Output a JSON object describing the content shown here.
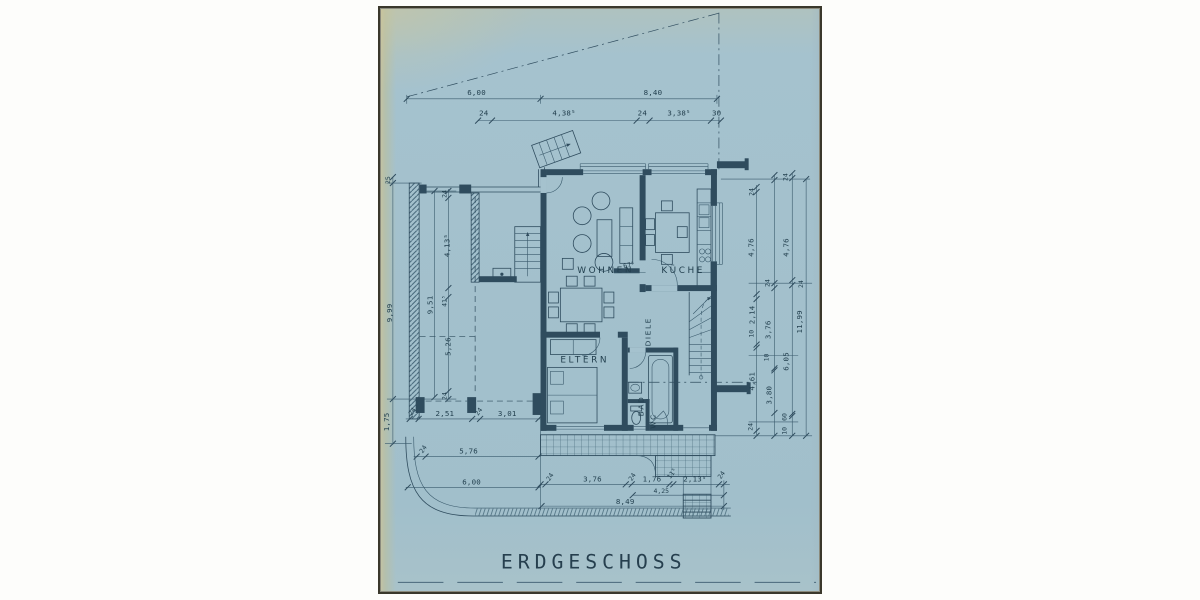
{
  "title": "ERDGESCHOSS",
  "rooms": {
    "wohnen": "WOHNEN",
    "kueche": "KÜCHE",
    "diele": "DIELE",
    "eltern": "ELTERN",
    "bad": "BAD",
    "wc": "WC"
  },
  "dims": {
    "top": {
      "t1": "6,00",
      "t2": "8,40",
      "t3": "24",
      "t4": "4,38⁵",
      "t5": "24",
      "t6": "3,38⁵",
      "t7": "30"
    },
    "left": {
      "l1": "25",
      "l2": "9,99",
      "l3": "9,51",
      "l4": "24",
      "l5": "4,13⁵",
      "l6": "41⁵",
      "l7": "5,26",
      "l8": "24",
      "l9": "1,75"
    },
    "bottom_left": {
      "b1": "24",
      "b2": "2,51",
      "b3": "24",
      "b4": "3,01",
      "b5": "24",
      "b6": "5,76",
      "b7": "6,00"
    },
    "bottom_right": {
      "b1": "24",
      "b2": "3,76",
      "b3": "24",
      "b4": "1,76",
      "b5": "11⁵",
      "b6": "2,13⁵",
      "b7": "24",
      "b8": "4,25",
      "b9": "8,49"
    },
    "right": {
      "r1": "24",
      "r2": "4,76",
      "r3": "24",
      "r4": "2,14",
      "r5": "10",
      "r6": "4,61",
      "r7": "24",
      "r8": "24",
      "r9": "4,76",
      "r10": "24",
      "r11": "3,76",
      "r12": "10",
      "r13": "6,05",
      "r14": "3,80",
      "r15": "60",
      "r16": "10",
      "r17": "11,99"
    },
    "note": "67⁵"
  }
}
